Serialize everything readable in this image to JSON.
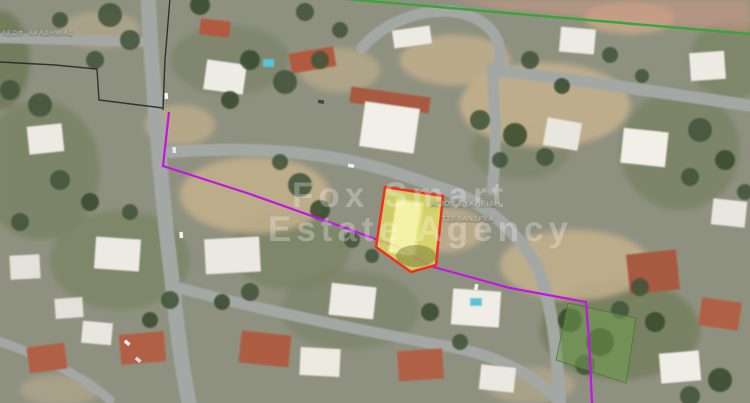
{
  "watermark": {
    "line1": "Fox Smart",
    "line2": "Estate Agency"
  },
  "labels": {
    "top_left_street": "ΛΕΩΦ. ΑΚΑΔΗΜΙΑΣ",
    "plot_street_line1": "ΑΓΙΟΥ ΕΥΚΛΕΙΔΗ",
    "plot_street_line2": "ΤΣΕΛΑΝΔΡΕΑ"
  },
  "map": {
    "type": "satellite-aerial-photo",
    "overlays": {
      "primary_plot_outline_color": "#ef2f21",
      "primary_plot_fill_color": "#e3e35f",
      "boundary_polyline_color": "#c314e3",
      "secondary_plot_fill_color": "#6f9c4e",
      "top_survey_line_color": "#3ca33c",
      "cadastral_line_color": "#222222"
    }
  }
}
